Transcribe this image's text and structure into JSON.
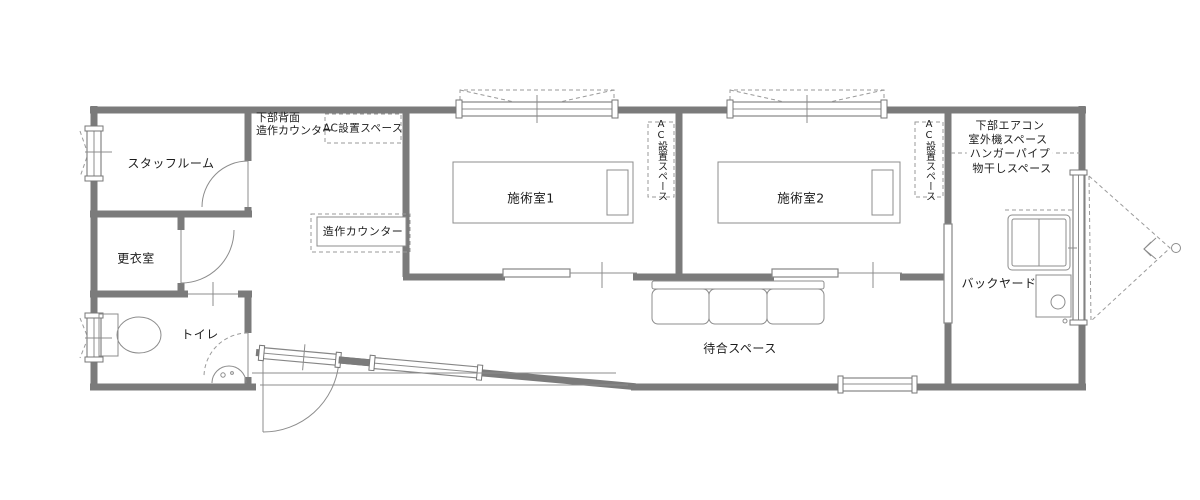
{
  "floorplan": {
    "rooms": {
      "staff_room": "スタッフルーム",
      "changing_room": "更衣室",
      "toilet": "トイレ",
      "treatment_room_1": "施術室1",
      "treatment_room_2": "施術室2",
      "waiting_space": "待合スペース",
      "backyard": "バックヤード"
    },
    "annotations": {
      "lower_back_counter_line1": "下部背面",
      "lower_back_counter_line2": "造作カウンター",
      "ac_space": "AC設置スペース",
      "built_in_counter": "造作カウンター",
      "lower_aircon_line1": "下部エアコン",
      "lower_aircon_line2": "室外機スペース",
      "hanger_pipe": "ハンガーパイプ",
      "drying_space": "物干しスペース"
    },
    "colors": {
      "wall": "#7b7b7b",
      "furniture_line": "#8c8c8c",
      "dashed_line": "#9a9a9a",
      "text": "#1c1c1c",
      "background": "#ffffff"
    }
  }
}
